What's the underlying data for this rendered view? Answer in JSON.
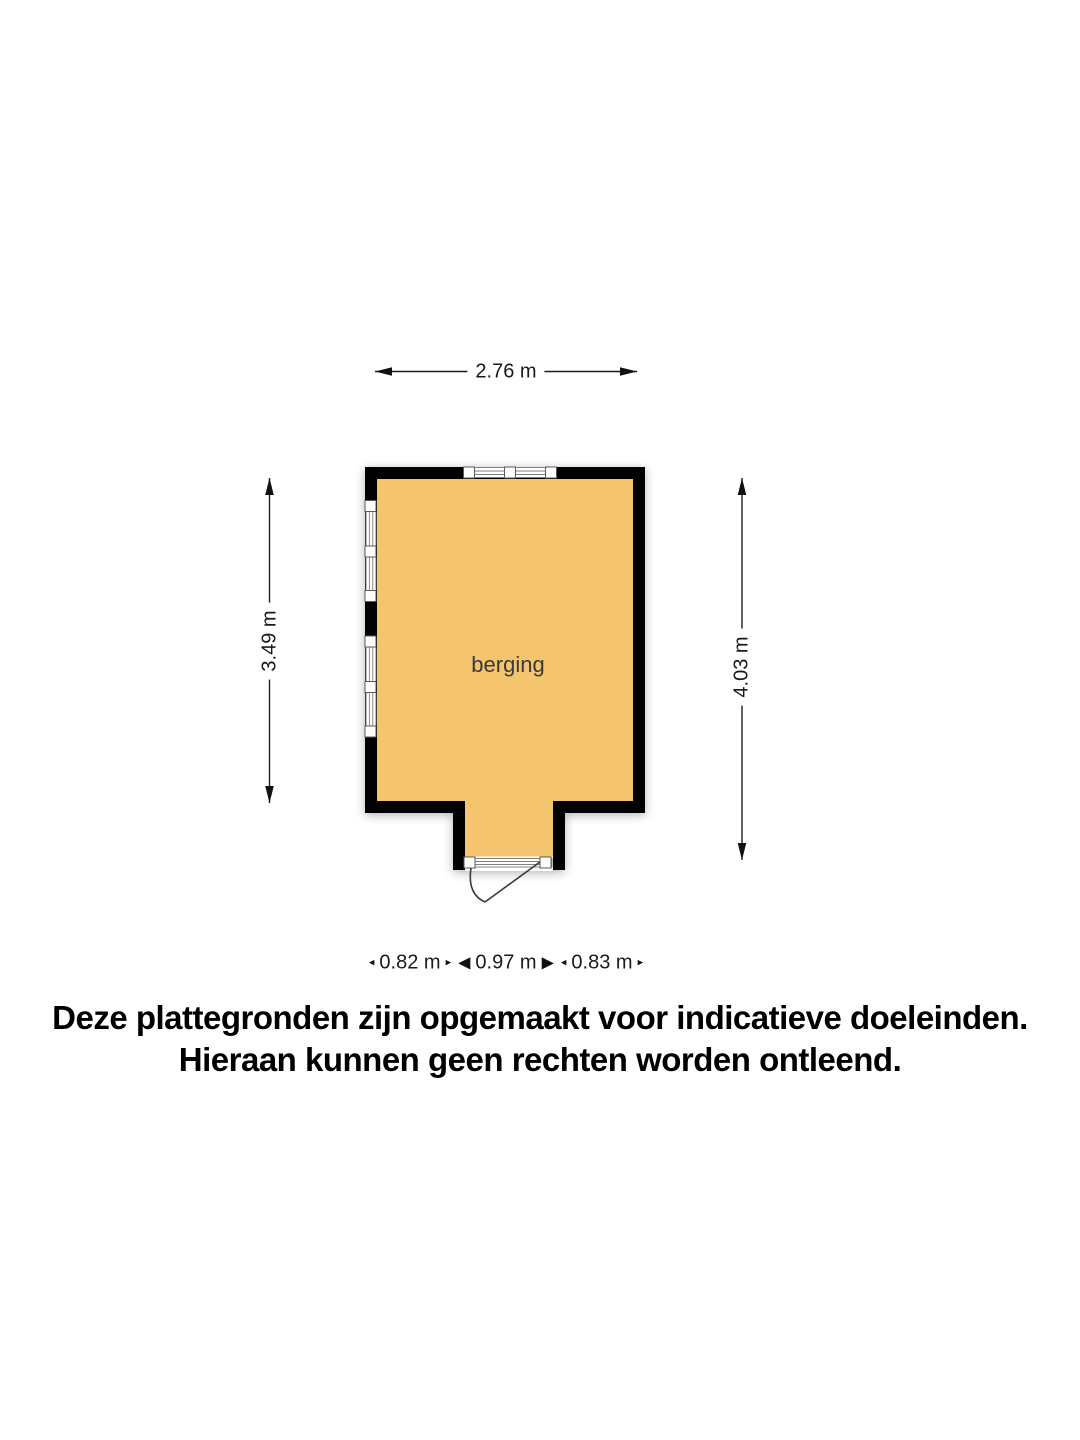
{
  "floorplan": {
    "room_label": "berging",
    "dimensions": {
      "top": "2.76 m",
      "left": "3.49 m",
      "right": "4.03 m",
      "bottom_segments": [
        {
          "label": "0.82 m",
          "arrow_size": "small"
        },
        {
          "label": "0.97 m",
          "arrow_size": "large"
        },
        {
          "label": "0.83 m",
          "arrow_size": "small"
        }
      ]
    },
    "colors": {
      "room_fill": "#F4C46F",
      "wall": "#000000",
      "window_frame": "#808080",
      "dimension_text": "#1a1a1a"
    }
  },
  "icons": {
    "arrow_small_left": "◂",
    "arrow_small_right": "▸",
    "arrow_large_left": "◀",
    "arrow_large_right": "▶"
  },
  "disclaimer": {
    "line1": "Deze plattegronden zijn opgemaakt voor indicatieve doeleinden.",
    "line2": "Hieraan kunnen geen rechten worden ontleend."
  }
}
